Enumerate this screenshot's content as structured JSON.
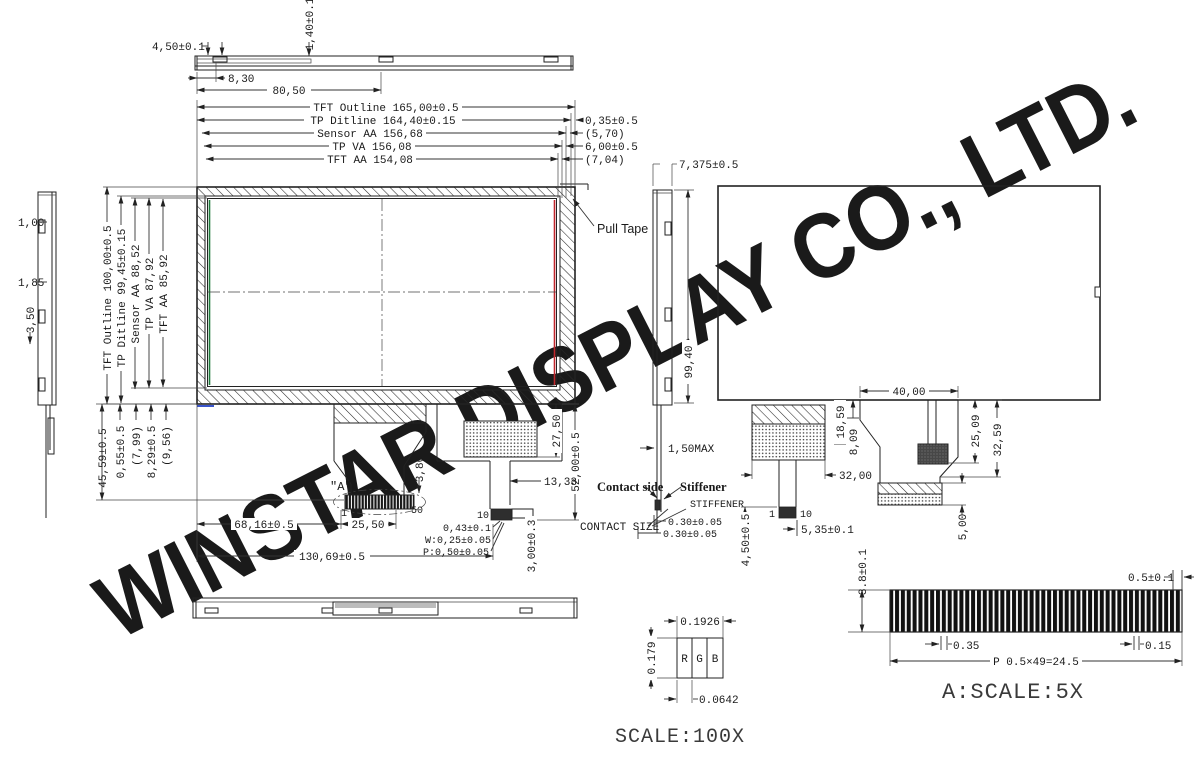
{
  "watermark": "WINSTAR DISPLAY CO., LTD.",
  "top_view": {
    "d_450": "4,50±0.1",
    "d_140": "1,40±0.1",
    "d_830": "8,30",
    "d_8050": "80,50"
  },
  "left_view": {
    "d_100": "1,00",
    "d_185": "1,85",
    "d_350": "3,50"
  },
  "front": {
    "h_chain": [
      "TFT Outline 165,00±0.5",
      "TP Ditline 164,40±0.15",
      "Sensor AA 156,68",
      "TP VA 156,08",
      "TFT AA 154,08"
    ],
    "h_offsets": [
      "0,35±0.5",
      "(5,70)",
      "6,00±0.5",
      "(7,04)"
    ],
    "v_chain": [
      "TFT Outline 100,00±0.5",
      "TP Ditline 99,45±0.15",
      "Sensor AA 88,52",
      "TP VA 87,92",
      "TFT AA 85,92"
    ],
    "v_offsets": [
      "45,59±0.5",
      "0,55±0.5",
      "(7,99)",
      "8,29±0.5",
      "(9,56)"
    ],
    "pull_tape": "Pull Tape"
  },
  "right_view": {
    "d_9940": "99,40",
    "d_7375": "7,375±0.5",
    "d_150max": "1,50MAX"
  },
  "fpc": {
    "detail_ref": "\"A\"",
    "pin_first": "1",
    "pin_last": "50",
    "d_380": "3,80",
    "d_6816": "68,16±0.5",
    "d_2550": "25,50",
    "d_13069": "130,69±0.5",
    "d_043": "0,43±0.1",
    "d_w025": "W:0,25±0.05",
    "d_p050": "P:0,50±0.05",
    "d_300": "3,00±0.3",
    "d_1333": "13,33",
    "d_2750": "27,50",
    "d_5200": "52,00±0.5",
    "pin10": "10"
  },
  "annot": {
    "contact_side": "Contact side",
    "stiffener": "Stiffener",
    "stiffener_caps": "STIFFENER",
    "contact_size": "CONTACT SIZE",
    "d_030_top": "0.30±0.05",
    "d_030_bot": "0.30±0.05"
  },
  "back": {
    "d_4000": "40,00",
    "d_1859": "18,59",
    "d_809": "8,09",
    "d_3200": "32,00",
    "d_2509": "25,09",
    "d_3259": "32,59",
    "d_500": "5,00",
    "d_535": "5,35±0.1",
    "d_450": "4,50±0.5",
    "pin1": "1",
    "pin10": "10"
  },
  "detail_a": {
    "d_38": "3.8±0.1",
    "d_05": "0.5±0.1",
    "d_035": "0.35",
    "d_015": "0.15",
    "d_pitch": "P 0.5×49=24.5",
    "scale": "A:SCALE:5X"
  },
  "pixel": {
    "d_width": "0.1926",
    "d_height": "0.179",
    "r": "R",
    "g": "G",
    "b": "B",
    "d_sub": "0.0642",
    "scale": "SCALE:100X"
  },
  "colors": {
    "line": "#222222",
    "red": "#c0272d",
    "green": "#1e7a3c",
    "blue": "#3a55cc",
    "watermark": "#d8d8d8"
  }
}
